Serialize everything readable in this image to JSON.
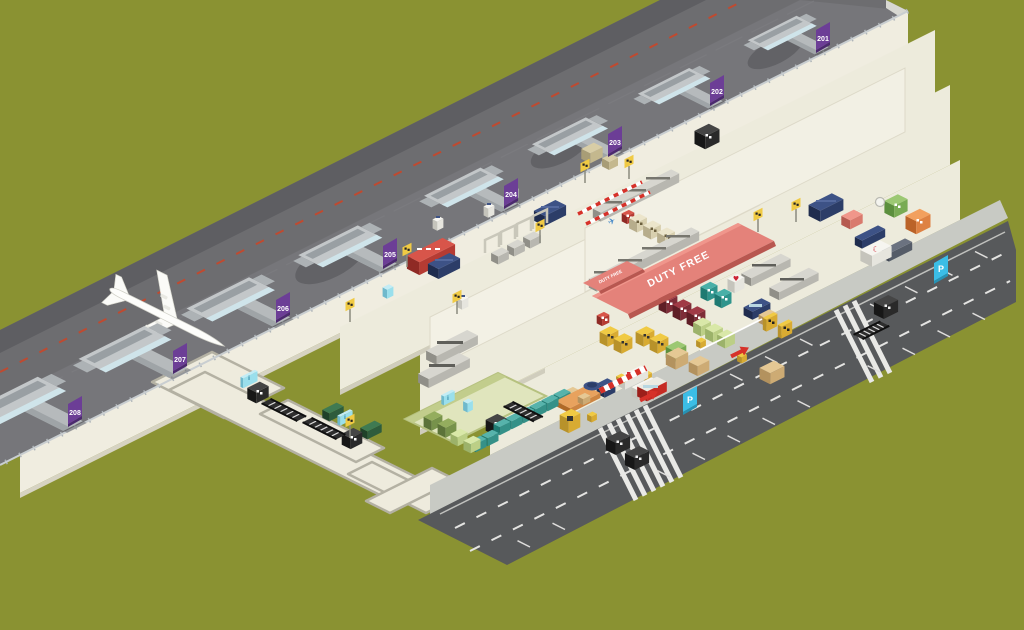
{
  "map": {
    "type": "airport-terminal-isometric-map",
    "gates": [
      {
        "label": "201"
      },
      {
        "label": "202"
      },
      {
        "label": "203"
      },
      {
        "label": "204"
      },
      {
        "label": "205"
      },
      {
        "label": "206"
      },
      {
        "label": "207"
      },
      {
        "label": "208"
      }
    ],
    "duty_free": {
      "label_main": "DUTY FREE",
      "label_small": "DUTY FREE"
    },
    "parking": {
      "label": "P"
    },
    "icons": {
      "pharmacy_heart": "♥",
      "medical_crescent": "☾",
      "airplane_floor": "✈",
      "info": "i"
    },
    "colors": {
      "background": "#8a9232",
      "apron": "#6d6d70",
      "terminal_floor": "#edebdc",
      "road": "#57595b",
      "gate_sign_purple": "#6c3e96",
      "duty_free_red": "#e4827a",
      "parking_cyan": "#3bbde6",
      "sign_yellow": "#f0ca44",
      "seat_navy": "#3d5286",
      "bench_teal": "#57b3ab"
    }
  }
}
